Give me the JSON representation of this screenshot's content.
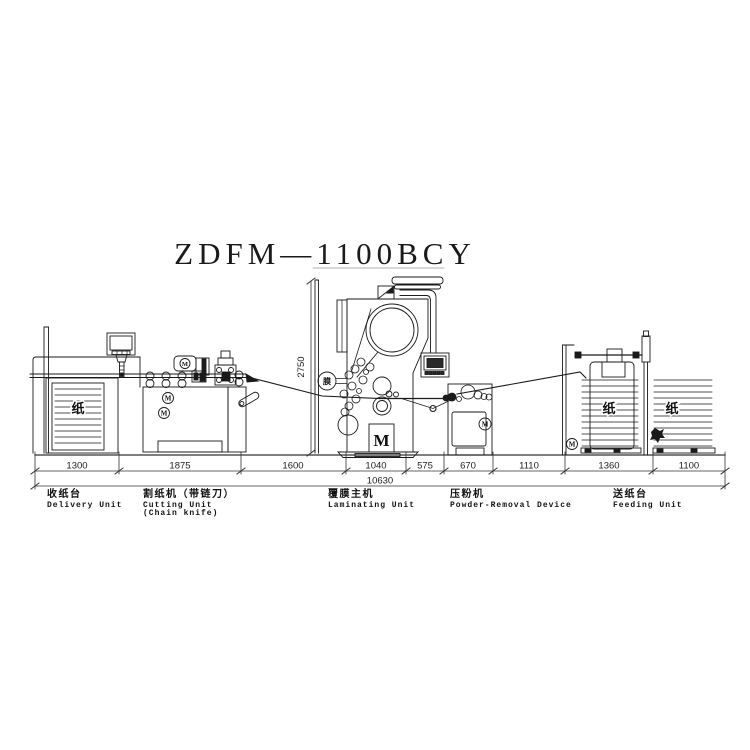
{
  "title": "ZDFM—1100BCY",
  "dimension_chain": {
    "height_label": "2750",
    "segments": [
      "1300",
      "1875",
      "1600",
      "1040",
      "575",
      "670",
      "1110",
      "1360",
      "1100"
    ],
    "total": "10630"
  },
  "units": {
    "delivery": {
      "name_zh": "收纸台",
      "name_en": "Delivery Unit"
    },
    "cutting": {
      "name_zh": "割纸机（带链刀）",
      "name_en": "Cutting Unit",
      "name_en2": "(Chain knife)"
    },
    "laminating": {
      "name_zh": "覆膜主机",
      "name_en": "Laminating Unit"
    },
    "powder": {
      "name_zh": "压粉机",
      "name_en": "Powder-Removal Device"
    },
    "feeding": {
      "name_zh": "送纸台",
      "name_en": "Feeding Unit"
    }
  },
  "glyphs": {
    "paper": "纸",
    "motor": "M",
    "film": "膜"
  }
}
